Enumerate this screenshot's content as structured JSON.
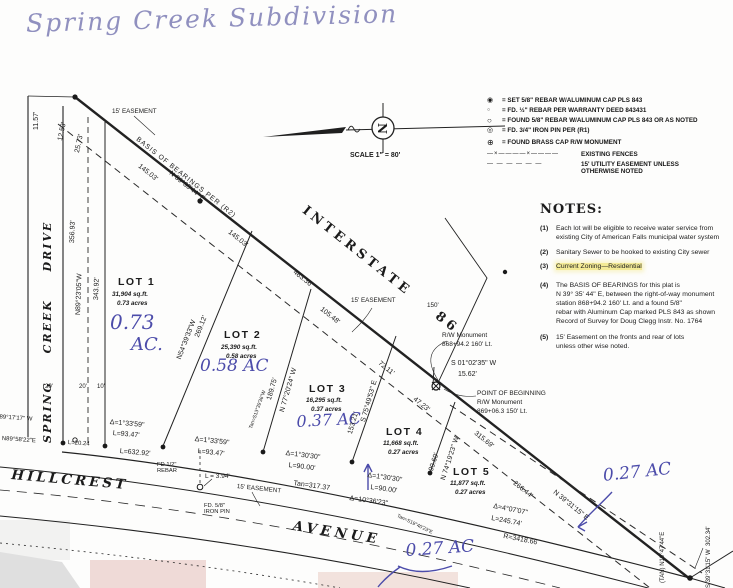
{
  "title": "Spring Creek Subdivision",
  "north": {
    "letter": "N"
  },
  "scale_label": "SCALE 1\" = 80'",
  "colors": {
    "handwriting_blue": "#4c4caa",
    "title_ink": "#9090bf",
    "note_highlight": "#f3ea96",
    "line_ink": "#222222"
  },
  "legend": {
    "items": [
      {
        "name": "set-rebar-icon",
        "glyph": "◉",
        "text": "= SET 5/8\" REBAR W/ALUMINUM CAP PLS 843"
      },
      {
        "name": "found-half-rebar-icon",
        "glyph": "○",
        "text": "= FD. ½\" REBAR PER WARRANTY DEED 843431"
      },
      {
        "name": "found-rebar-icon",
        "glyph": "○",
        "text": "= FOUND 5/8\" REBAR W/ALUMINUM CAP PLS 843 OR AS NOTED"
      },
      {
        "name": "iron-pin-icon",
        "glyph": "◎",
        "text": "= FD. 3/4\" IRON PIN PER (R1)"
      },
      {
        "name": "brass-cap-icon",
        "glyph": "⊕",
        "text": "= FOUND BRASS CAP R/W MONUMENT"
      },
      {
        "name": "fence-line-icon",
        "glyph": "—×————×————",
        "text": "EXISTING FENCES"
      },
      {
        "name": "easement-line-icon",
        "glyph": "— — — — — —",
        "text": "15' UTILITY EASEMENT UNLESS\nOTHERWISE NOTED"
      }
    ]
  },
  "notes": {
    "heading": "NOTES:",
    "items": [
      {
        "num": "(1)",
        "text": "Each lot will be eligible to receive water service from\nexisting City of American Falls municipal water system"
      },
      {
        "num": "(2)",
        "text": "Sanitary Sewer to be hooked to existing City sewer"
      },
      {
        "num": "(3)",
        "text": "Current Zoning—Residential"
      },
      {
        "num": "(4)",
        "text": "The BASIS OF BEARINGS for this plat is\nN 39° 35' 44\" E, between the right-of-way monument\nstation 868+94.2 160' Lt. and a found 5/8\"\nrebar with Aluminum Cap marked PLS 843 as shown\nRecord of Survey for Doug Clegg Instr. No. 1764"
      },
      {
        "num": "(5)",
        "text": "15' Easement on the fronts and rear of lots\nunless other wise noted."
      }
    ]
  },
  "roads": {
    "interstate": "INTERSTATE    86",
    "spring_creek_drive": "SPRING  CREEK  DRIVE",
    "hillcrest": "HILLCREST",
    "avenue": "AVENUE"
  },
  "lots": [
    {
      "name": "LOT 1",
      "sqft": "31,904 sq.ft.",
      "acres": "0.73 acres"
    },
    {
      "name": "LOT 2",
      "sqft": "25,390 sq.ft.",
      "acres": "0.58 acres"
    },
    {
      "name": "LOT 3",
      "sqft": "16,295 sq.ft.",
      "acres": "0.37 acres"
    },
    {
      "name": "LOT 4",
      "sqft": "11,668 sq.ft.",
      "acres": "0.27 acres"
    },
    {
      "name": "LOT 5",
      "sqft": "11,877 sq.ft.",
      "acres": "0.27 acres"
    }
  ],
  "hand": {
    "lot1_num": "0.73",
    "lot1_ac": "AC.",
    "lot2": "0.58 AC",
    "lot3": "0.37 AC",
    "lot5": "0.27 AC",
    "bottom": "0.27 AC"
  },
  "dims": {
    "basis": "BASIS OF BEARINGS PER (R2)",
    "brg_main": "N 39°35'44\" E",
    "d145a": "145.03'",
    "d145b": "145.03'",
    "d463": "463.36'",
    "d105": "105.48'",
    "ease_top": "15' EASEMENT",
    "ease_mid": "15' EASEMENT",
    "ease_bot": "15' EASEMENT",
    "d150": "150'",
    "d72": "72.11'",
    "d47": "47.23'",
    "d315": "315.69'",
    "d266": "266.44'",
    "ne_brg": "N 39°31'15\" E",
    "lot12_brg": "N54°39'33\"W",
    "lot12_len": "269.12'",
    "lot23_len": "189.75'",
    "lot23_brg": "N 77°20'24\" W",
    "lot34_len": "153.21'",
    "lot34_brg": "S 75°49'53\" E",
    "lot45_len": "99.69'",
    "lot45_brg": "N 74°19'23\" W",
    "rw_mon1": "R/W Monument",
    "rw_mon1_sta": "868+94.2 160' Lt.",
    "tie_brg": "S 01°02'35\" W",
    "tie_len": "15.62'",
    "pob1": "POINT OF BEGINNING",
    "pob2": "R/W Monument",
    "pob3": "869+06.3 150' Lt.",
    "c1d": "Δ=1°33'59\"",
    "c1l": "L=93.47'",
    "c2d": "Δ=1°33'59\"",
    "c2l": "L=93.47'",
    "c3l": "L=632.92'",
    "c4l": "L=20.24",
    "c5d": "Δ=1°30'30\"",
    "c5l": "L=90.00'",
    "c6d": "Δ=1°30'30\"",
    "c6l": "L=90.00'",
    "c7d": "Δ=10°36'23\"",
    "tan1": "Tan=317.37",
    "c8d": "Δ=4°07'07\"",
    "c8l": "L=245.74'",
    "c8r": "R=3418.66",
    "tansm1": "Tan=S13°39'36\"W",
    "tansm2": "Tan=S19°40'23\"E",
    "l394": "L = 3.94'",
    "fd12": "FD 1/2\"\nREBAR",
    "fd58": "FD. 5/8\"\nIRON PIN",
    "w_brg": "N89°23'05\"W",
    "w_len": "356.93'",
    "w_dash": "343.92'",
    "t1": "11.57'",
    "t2": "12.53'",
    "t3": "25.73'",
    "w20a": "20'",
    "w20b": "20'",
    "w10": "10'",
    "sw1": "S 89°17'17\" W",
    "sw2": "N89°58'22\"E",
    "tanR": "(TAN) N19°47'44\"E",
    "rbrg": "S 39°31'15\" W  302.34'"
  }
}
